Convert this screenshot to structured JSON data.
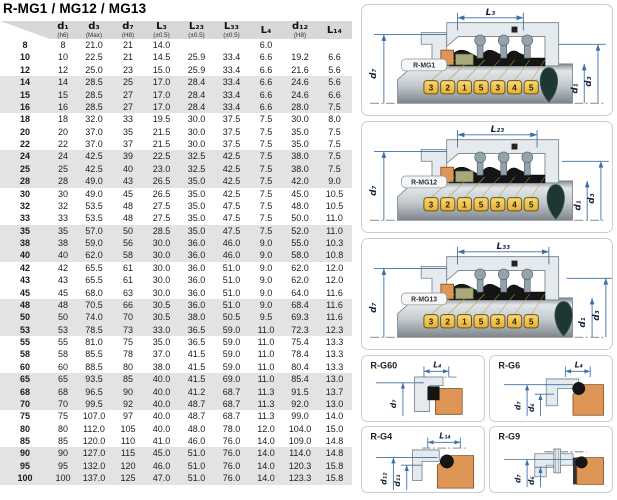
{
  "title": "R-MG1 / MG12 / MG13",
  "table": {
    "headers": [
      {
        "main": "",
        "sub": ""
      },
      {
        "main": "d₁",
        "sub": "(h6)"
      },
      {
        "main": "d₃",
        "sub": "(Max)"
      },
      {
        "main": "d₇",
        "sub": "(H8)"
      },
      {
        "main": "L₃",
        "sub": "(±0.5)"
      },
      {
        "main": "L₂₃",
        "sub": "(±0.5)"
      },
      {
        "main": "L₃₃",
        "sub": "(±0.5)"
      },
      {
        "main": "L₄",
        "sub": ""
      },
      {
        "main": "d₁₂",
        "sub": "(H8)"
      },
      {
        "main": "L₁₄",
        "sub": ""
      }
    ],
    "rows": [
      [
        "8",
        "8",
        "21.0",
        "21",
        "14.0",
        "",
        "",
        "6.0",
        "",
        ""
      ],
      [
        "10",
        "10",
        "22.5",
        "21",
        "14.5",
        "25.9",
        "33.4",
        "6.6",
        "19.2",
        "6.6"
      ],
      [
        "12",
        "12",
        "25.0",
        "23",
        "15.0",
        "25.9",
        "33.4",
        "6.6",
        "21.6",
        "5.6"
      ],
      [
        "14",
        "14",
        "28.5",
        "25",
        "17.0",
        "28.4",
        "33.4",
        "6.6",
        "24.6",
        "5.6"
      ],
      [
        "15",
        "15",
        "28.5",
        "27",
        "17.0",
        "28.4",
        "33.4",
        "6.6",
        "24.6",
        "6.6"
      ],
      [
        "16",
        "16",
        "28.5",
        "27",
        "17.0",
        "28.4",
        "33.4",
        "6.6",
        "28.0",
        "7.5"
      ],
      [
        "18",
        "18",
        "32.0",
        "33",
        "19.5",
        "30.0",
        "37.5",
        "7.5",
        "30.0",
        "8.0"
      ],
      [
        "20",
        "20",
        "37.0",
        "35",
        "21.5",
        "30.0",
        "37.5",
        "7.5",
        "35.0",
        "7.5"
      ],
      [
        "22",
        "22",
        "37.0",
        "37",
        "21.5",
        "30.0",
        "37.5",
        "7.5",
        "35.0",
        "7.5"
      ],
      [
        "24",
        "24",
        "42.5",
        "39",
        "22.5",
        "32.5",
        "42.5",
        "7.5",
        "38.0",
        "7.5"
      ],
      [
        "25",
        "25",
        "42.5",
        "40",
        "23.0",
        "32.5",
        "42.5",
        "7.5",
        "38.0",
        "7.5"
      ],
      [
        "28",
        "28",
        "49.0",
        "43",
        "26.5",
        "35.0",
        "42.5",
        "7.5",
        "42.0",
        "9.0"
      ],
      [
        "30",
        "30",
        "49.0",
        "45",
        "26.5",
        "35.0",
        "42.5",
        "7.5",
        "45.0",
        "10.5"
      ],
      [
        "32",
        "32",
        "53.5",
        "48",
        "27.5",
        "35.0",
        "47.5",
        "7.5",
        "48.0",
        "10.5"
      ],
      [
        "33",
        "33",
        "53.5",
        "48",
        "27.5",
        "35.0",
        "47.5",
        "7.5",
        "50.0",
        "11.0"
      ],
      [
        "35",
        "35",
        "57.0",
        "50",
        "28.5",
        "35.0",
        "47.5",
        "7.5",
        "52.0",
        "11.0"
      ],
      [
        "38",
        "38",
        "59.0",
        "56",
        "30.0",
        "36.0",
        "46.0",
        "9.0",
        "55.0",
        "10.3"
      ],
      [
        "40",
        "40",
        "62.0",
        "58",
        "30.0",
        "36.0",
        "46.0",
        "9.0",
        "58.0",
        "10.8"
      ],
      [
        "42",
        "42",
        "65.5",
        "61",
        "30.0",
        "36.0",
        "51.0",
        "9.0",
        "62.0",
        "12.0"
      ],
      [
        "43",
        "43",
        "65.5",
        "61",
        "30.0",
        "36.0",
        "51.0",
        "9.0",
        "62.0",
        "12.0"
      ],
      [
        "45",
        "45",
        "68.0",
        "63",
        "30.0",
        "36.0",
        "51.0",
        "9.0",
        "64.0",
        "11.6"
      ],
      [
        "48",
        "48",
        "70.5",
        "66",
        "30.5",
        "36.0",
        "51.0",
        "9.0",
        "68.4",
        "11.6"
      ],
      [
        "50",
        "50",
        "74.0",
        "70",
        "30.5",
        "38.0",
        "50.5",
        "9.5",
        "69.3",
        "11.6"
      ],
      [
        "53",
        "53",
        "78.5",
        "73",
        "33.0",
        "36.5",
        "59.0",
        "11.0",
        "72.3",
        "12.3"
      ],
      [
        "55",
        "55",
        "81.0",
        "75",
        "35.0",
        "36.5",
        "59.0",
        "11.0",
        "75.4",
        "13.3"
      ],
      [
        "58",
        "58",
        "85.5",
        "78",
        "37.0",
        "41.5",
        "59.0",
        "11.0",
        "78.4",
        "13.3"
      ],
      [
        "60",
        "60",
        "88.5",
        "80",
        "38.0",
        "41.5",
        "59.0",
        "11.0",
        "80.4",
        "13.3"
      ],
      [
        "65",
        "65",
        "93.5",
        "85",
        "40.0",
        "41.5",
        "69.0",
        "11.0",
        "85.4",
        "13.0"
      ],
      [
        "68",
        "68",
        "96.5",
        "90",
        "40.0",
        "41.2",
        "68.7",
        "11.3",
        "91.5",
        "13.7"
      ],
      [
        "70",
        "70",
        "99.5",
        "92",
        "40.0",
        "48.7",
        "68.7",
        "11.3",
        "92.0",
        "13.0"
      ],
      [
        "75",
        "75",
        "107.0",
        "97",
        "40.0",
        "48.7",
        "68.7",
        "11.3",
        "99.0",
        "14.0"
      ],
      [
        "80",
        "80",
        "112.0",
        "105",
        "40.0",
        "48.0",
        "78.0",
        "12.0",
        "104.0",
        "15.0"
      ],
      [
        "85",
        "85",
        "120.0",
        "110",
        "41.0",
        "46.0",
        "76.0",
        "14.0",
        "109.0",
        "14.8"
      ],
      [
        "90",
        "90",
        "127.0",
        "115",
        "45.0",
        "51.0",
        "76.0",
        "14.0",
        "114.0",
        "14.8"
      ],
      [
        "95",
        "95",
        "132.0",
        "120",
        "46.0",
        "51.0",
        "76.0",
        "14.0",
        "120.3",
        "15.8"
      ],
      [
        "100",
        "100",
        "137.0",
        "125",
        "47.0",
        "51.0",
        "76.0",
        "14.0",
        "123.3",
        "15.8"
      ]
    ]
  },
  "diagrams": [
    {
      "label": "R-MG1",
      "top_dim": "L₃",
      "left_dim": "d₇",
      "right_dim_inner": "d₁",
      "right_dim_outer": "d₃",
      "tags": [
        "3",
        "2",
        "1",
        "5",
        "3",
        "4",
        "5"
      ]
    },
    {
      "label": "R-MG12",
      "top_dim": "L₂₃",
      "left_dim": "d₇",
      "right_dim_inner": "d₁",
      "right_dim_outer": "d₃",
      "tags": [
        "3",
        "2",
        "1",
        "5",
        "3",
        "4",
        "5"
      ]
    },
    {
      "label": "R-MG13",
      "top_dim": "L₃₃",
      "left_dim": "d₇",
      "right_dim_inner": "d₁",
      "right_dim_outer": "d₃",
      "tags": [
        "3",
        "2",
        "1",
        "5",
        "3",
        "4",
        "5"
      ]
    }
  ],
  "seats": [
    {
      "label": "R-G60",
      "top_dim": "L₄",
      "dims": [
        "d₇"
      ]
    },
    {
      "label": "R-G6",
      "top_dim": "L₄",
      "dims": [
        "d₇",
        "d₆"
      ]
    },
    {
      "label": "R-G4",
      "top_dim": "L₁₄",
      "dims": [
        "d₁₂",
        "d₁₁"
      ]
    },
    {
      "label": "R-G9",
      "top_dim": "",
      "dims": [
        "d₇",
        "d₆"
      ]
    }
  ],
  "colors": {
    "dimension_blue": "#3a6fa8",
    "tag_gold": "#f0c24b",
    "seat_orange": "#dd9655",
    "face_olive": "#a9aa7b",
    "metal_light": "#e4eaed",
    "rubber_black": "#151515",
    "header_gray": "#d8d8d8",
    "row_shade": "#e3e3e3"
  }
}
